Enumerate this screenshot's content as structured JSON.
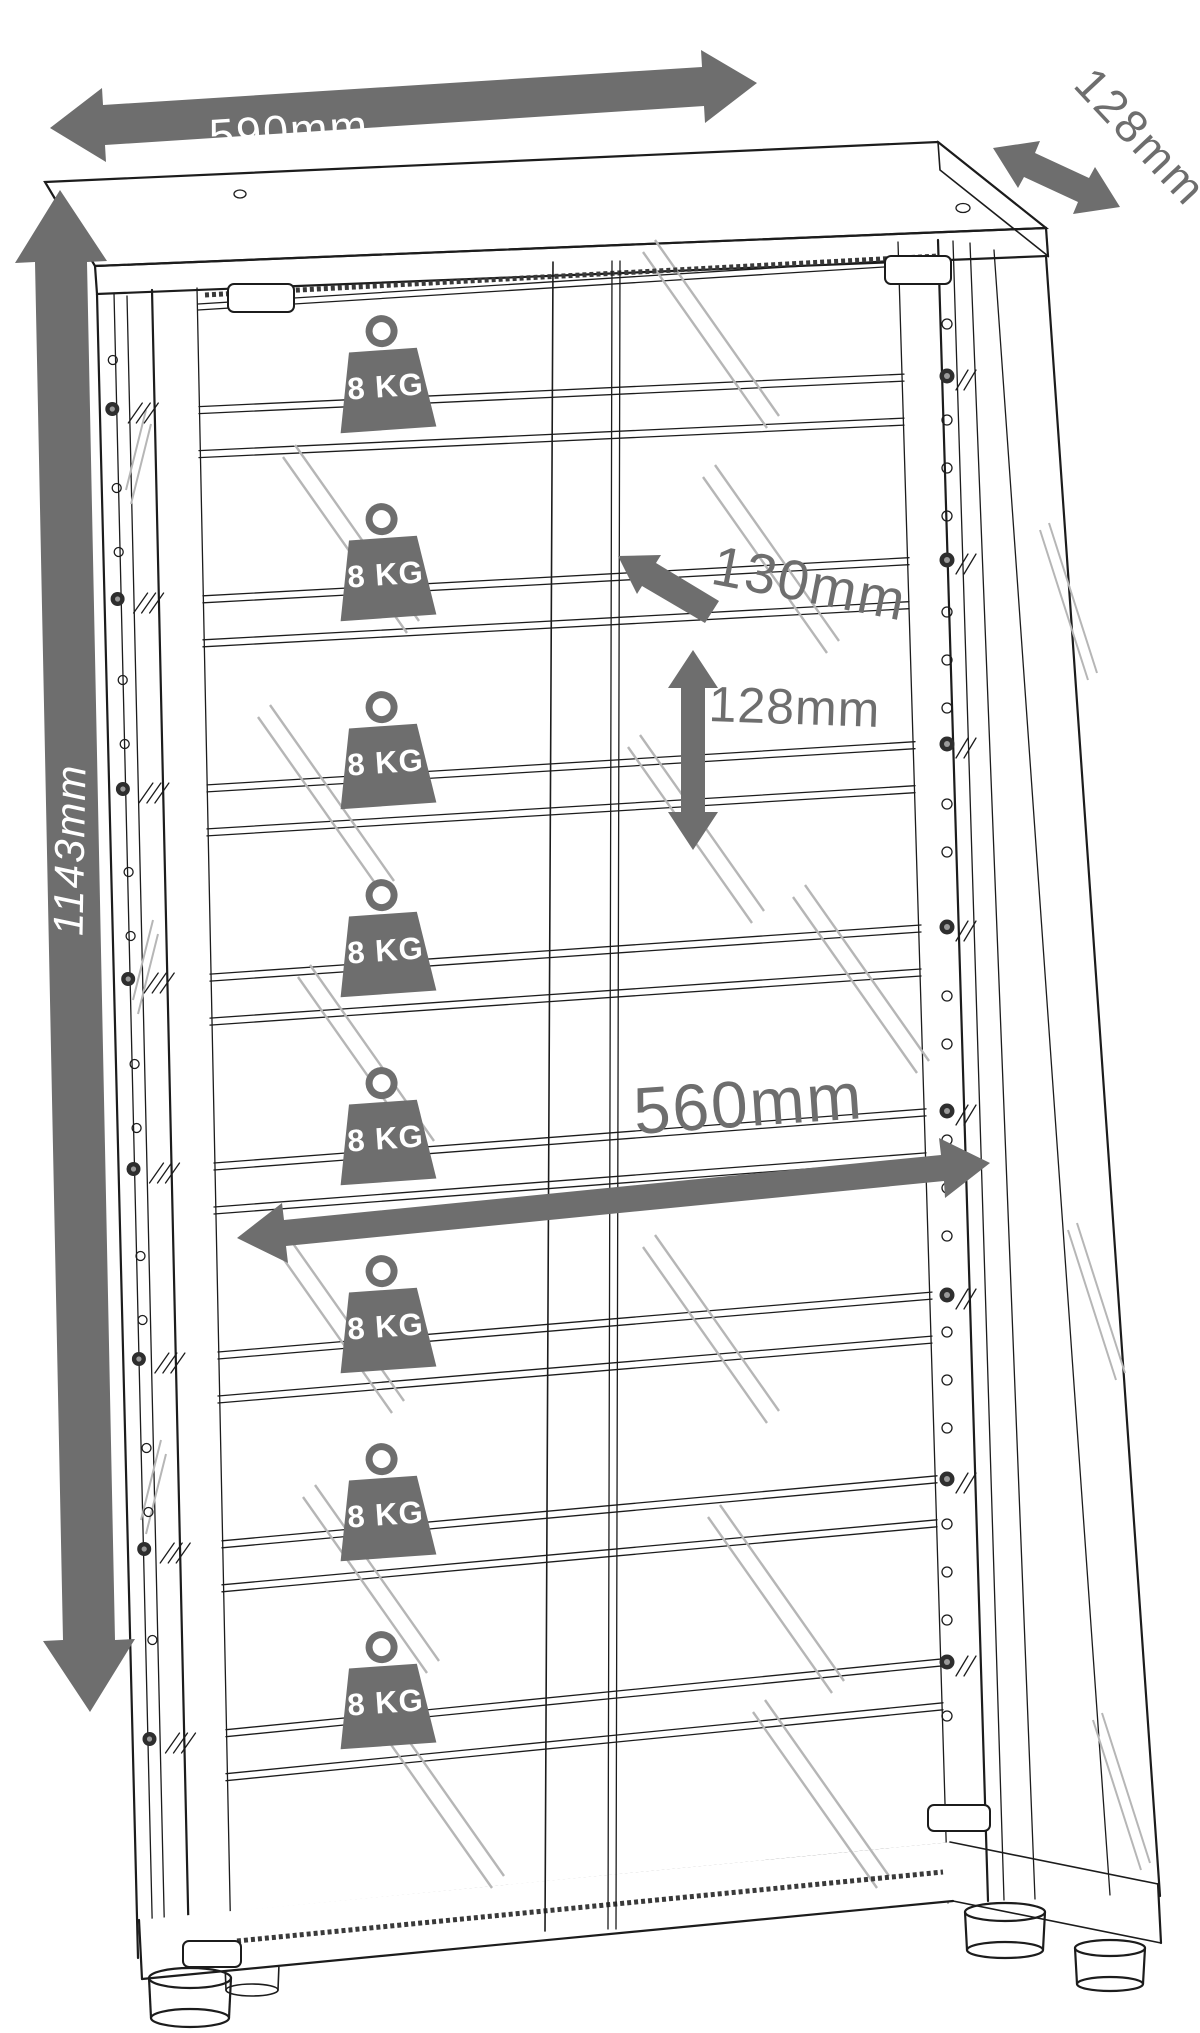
{
  "dimensions": {
    "top_width": {
      "label": "590mm",
      "value_mm": 590
    },
    "top_depth": {
      "label": "128mm",
      "value_mm": 128
    },
    "left_height": {
      "label": "1143mm",
      "value_mm": 1143
    },
    "shelf_depth": {
      "label": "130mm",
      "value_mm": 130
    },
    "shelf_pitch": {
      "label": "128mm",
      "value_mm": 128
    },
    "inner_width": {
      "label": "560mm",
      "value_mm": 560
    }
  },
  "shelf_loads": [
    {
      "label": "8 KG",
      "value_kg": 8
    },
    {
      "label": "8 KG",
      "value_kg": 8
    },
    {
      "label": "8 KG",
      "value_kg": 8
    },
    {
      "label": "8 KG",
      "value_kg": 8
    },
    {
      "label": "8 KG",
      "value_kg": 8
    },
    {
      "label": "8 KG",
      "value_kg": 8
    },
    {
      "label": "8 KG",
      "value_kg": 8
    },
    {
      "label": "8 KG",
      "value_kg": 8
    }
  ],
  "colors": {
    "dimension_gray": "#6e6e6e",
    "line_black": "#1c1c1c",
    "reflection_gray": "#b6b6b6",
    "background": "#ffffff",
    "label_white": "#ffffff"
  }
}
